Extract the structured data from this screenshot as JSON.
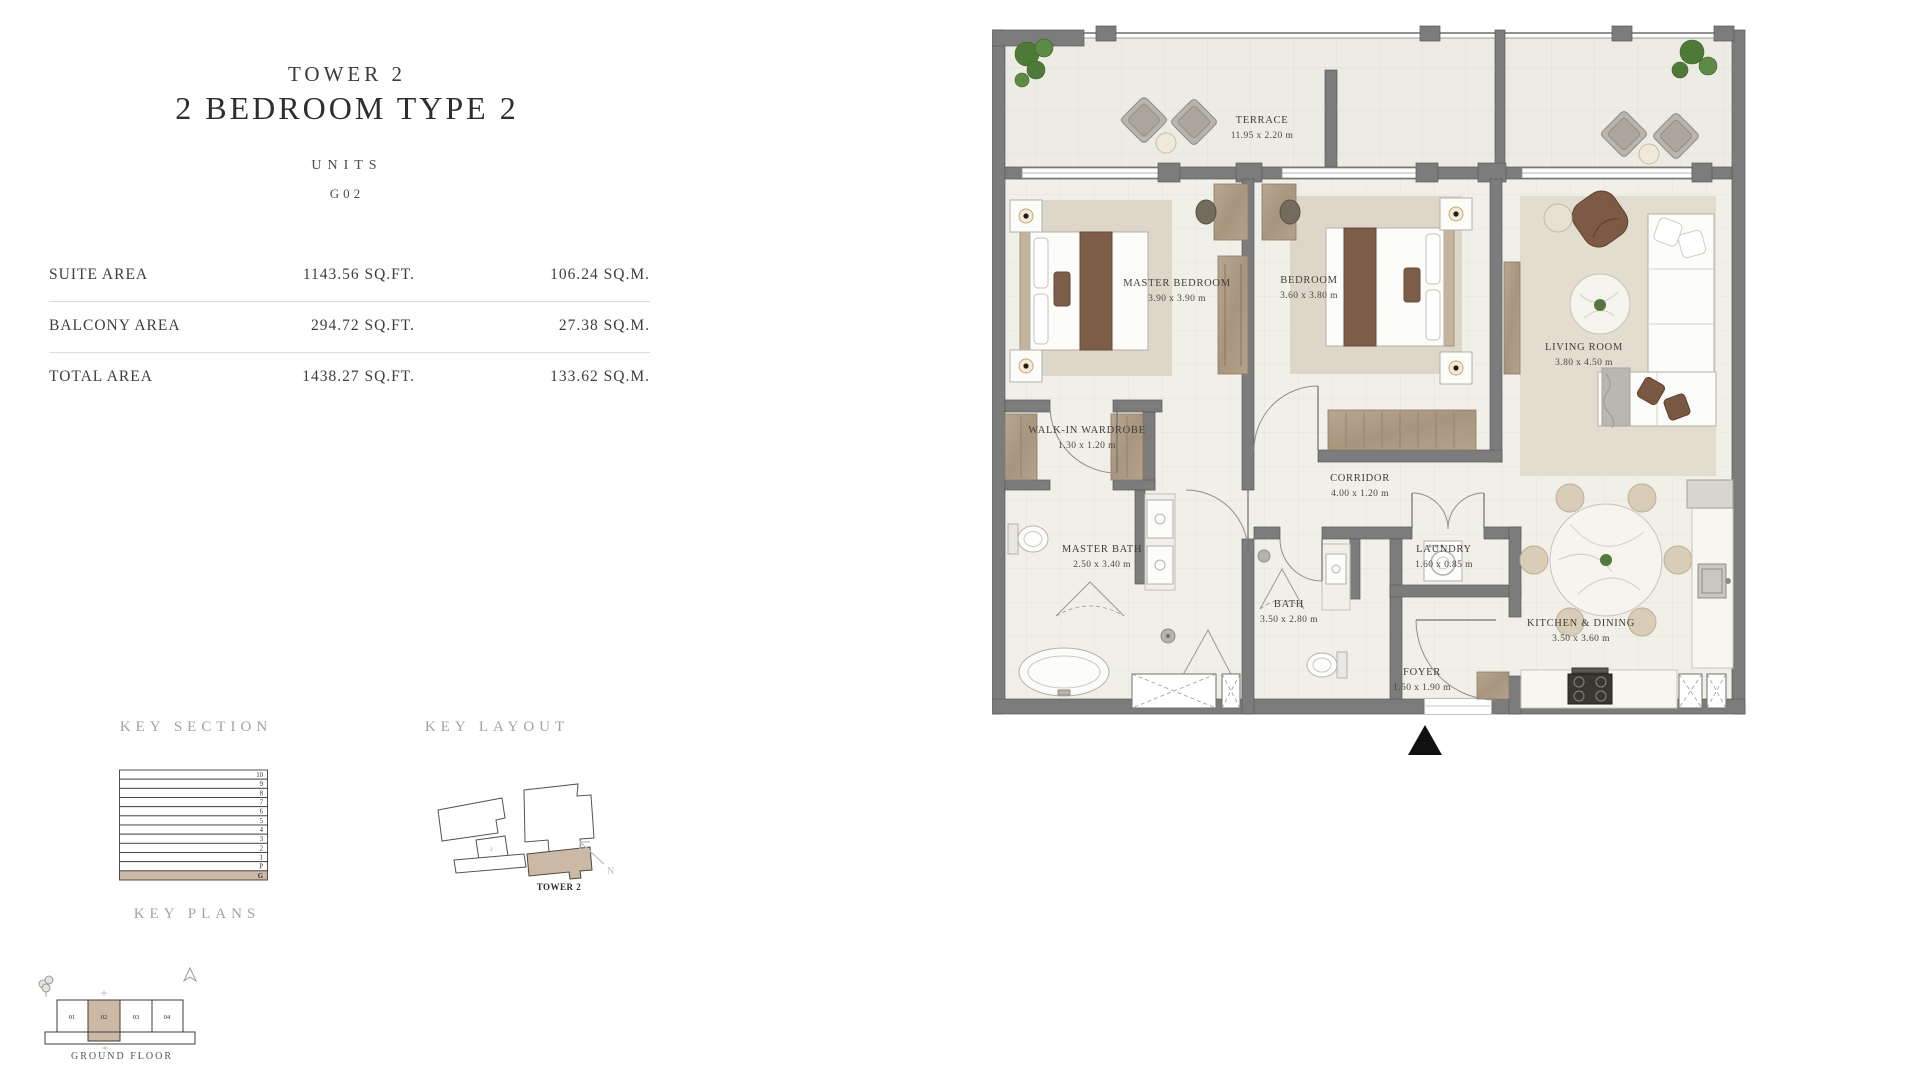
{
  "panel": {
    "tower": "TOWER 2",
    "title": "2 BEDROOM TYPE 2",
    "units_label": "UNITS",
    "unit_number": "G02",
    "areas": [
      {
        "label": "SUITE AREA",
        "sqft": "1143.56 SQ.FT.",
        "sqm": "106.24 SQ.M."
      },
      {
        "label": "BALCONY AREA",
        "sqft": "294.72 SQ.FT.",
        "sqm": "27.38 SQ.M."
      },
      {
        "label": "TOTAL AREA",
        "sqft": "1438.27 SQ.FT.",
        "sqm": "133.62 SQ.M."
      }
    ],
    "key_section_label": "KEY SECTION",
    "key_layout_label": "KEY LAYOUT",
    "key_plans_label": "KEY PLANS",
    "key_section_floors": [
      "10",
      "9",
      "8",
      "7",
      "6",
      "5",
      "4",
      "3",
      "2",
      "1",
      "P",
      "G"
    ],
    "key_section_highlight": "G",
    "key_layout_tower_label": "TOWER 2",
    "north_label": "N",
    "ground_floor_label": "GROUND  FLOOR",
    "ground_floor_units": [
      "01",
      "02",
      "03",
      "04"
    ],
    "ground_floor_highlight": "02"
  },
  "floorplan": {
    "rooms": [
      {
        "name": "TERRACE",
        "dims": "11.95 x 2.20 m"
      },
      {
        "name": "MASTER BEDROOM",
        "dims": "3.90 x 3.90 m"
      },
      {
        "name": "BEDROOM",
        "dims": "3.60 x 3.80 m"
      },
      {
        "name": "LIVING ROOM",
        "dims": "3.80 x 4.50 m"
      },
      {
        "name": "WALK-IN WARDROBE",
        "dims": "1.30 x 1.20 m"
      },
      {
        "name": "CORRIDOR",
        "dims": "4.00 x 1.20 m"
      },
      {
        "name": "MASTER BATH",
        "dims": "2.50 x 3.40 m"
      },
      {
        "name": "BATH",
        "dims": "3.50 x 2.80 m"
      },
      {
        "name": "LAUNDRY",
        "dims": "1.60 x 0.85 m"
      },
      {
        "name": "FOYER",
        "dims": "1.50 x 1.90 m"
      },
      {
        "name": "KITCHEN & DINING",
        "dims": "3.50 x 3.60 m"
      }
    ],
    "colors": {
      "accent": "#cbb9a6",
      "wall": "#7c7c7c",
      "floor": "#efeee8",
      "wood": "#ad9c87"
    }
  }
}
